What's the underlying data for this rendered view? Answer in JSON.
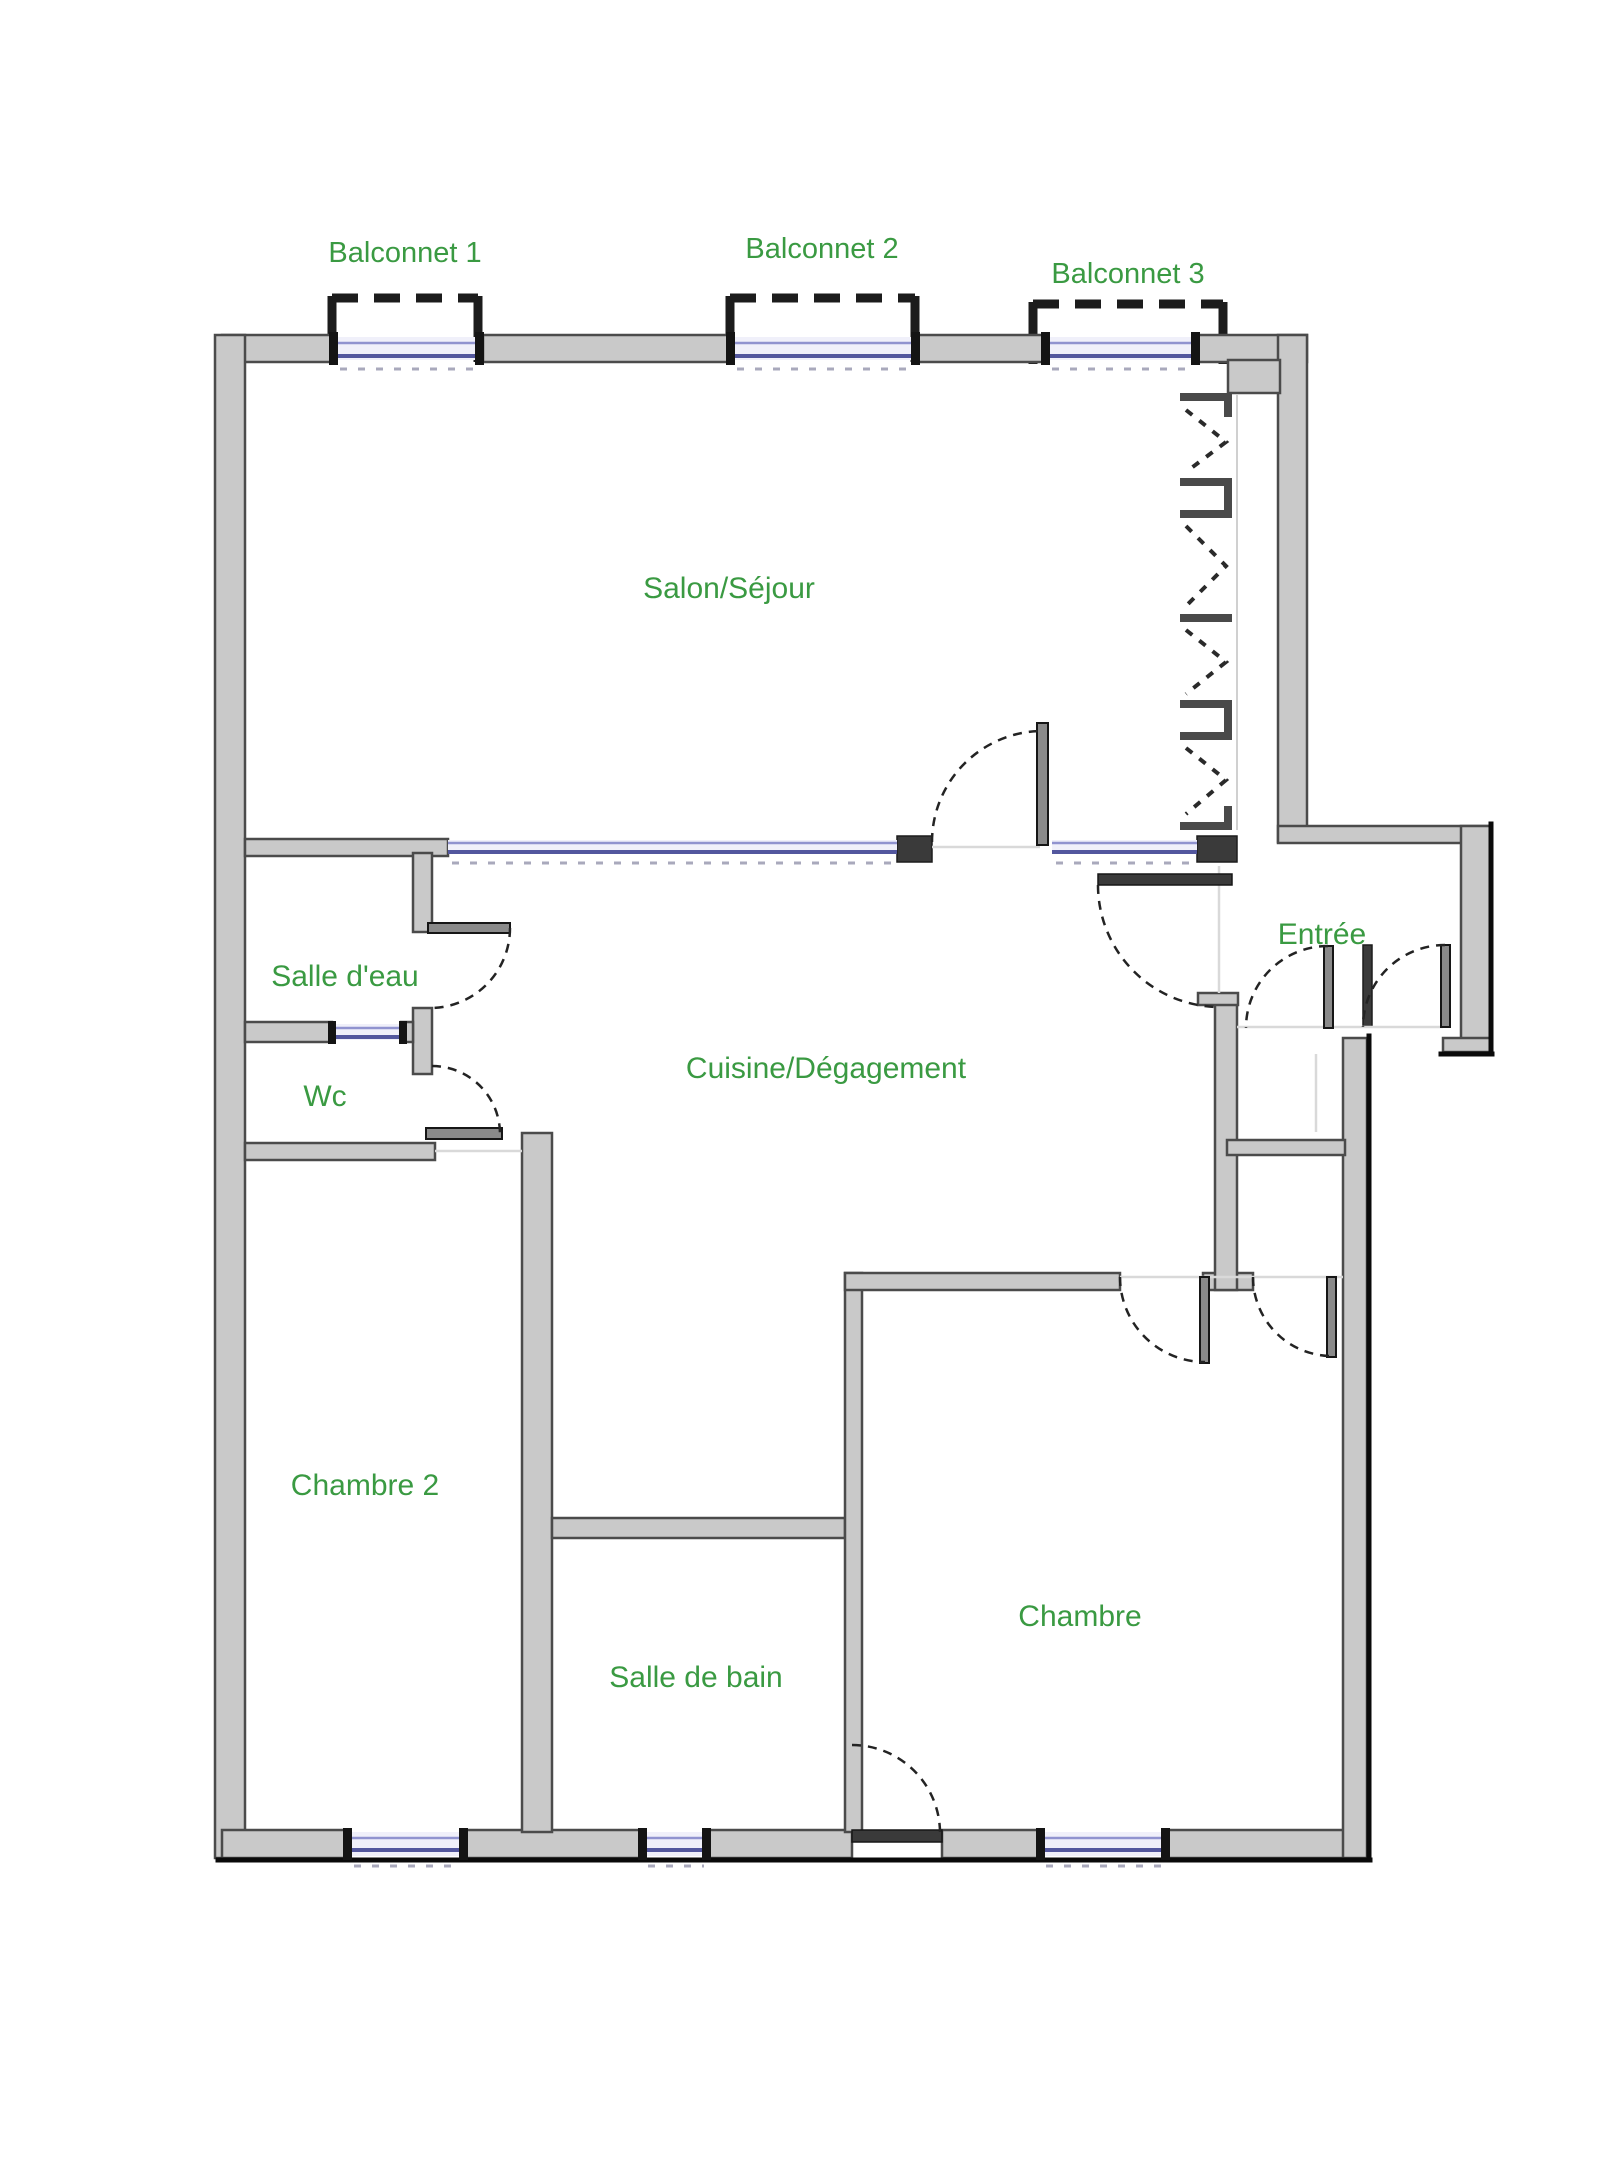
{
  "plan": {
    "type": "apartment-floor-plan",
    "colors": {
      "background": "#ffffff",
      "wall_fill": "#c9c9c9",
      "wall_edge": "#4b4b4b",
      "window_glass_light": "#9093cf",
      "window_glass_dark": "#53579e",
      "label_green": "#3a9a42",
      "balcony_dash": "#1c1c1c"
    },
    "balconies": [
      {
        "name": "balconnet-1",
        "label": "Balconnet 1"
      },
      {
        "name": "balconnet-2",
        "label": "Balconnet 2"
      },
      {
        "name": "balconnet-3",
        "label": "Balconnet 3"
      }
    ],
    "rooms": [
      {
        "name": "salon-sejour",
        "label": "Salon/Séjour"
      },
      {
        "name": "salle-deau",
        "label": "Salle d'eau"
      },
      {
        "name": "wc",
        "label": "Wc"
      },
      {
        "name": "cuisine-degagement",
        "label": "Cuisine/Dégagement"
      },
      {
        "name": "entree",
        "label": "Entrée"
      },
      {
        "name": "chambre-2",
        "label": "Chambre 2"
      },
      {
        "name": "salle-de-bain",
        "label": "Salle de bain"
      },
      {
        "name": "chambre",
        "label": "Chambre"
      }
    ]
  }
}
